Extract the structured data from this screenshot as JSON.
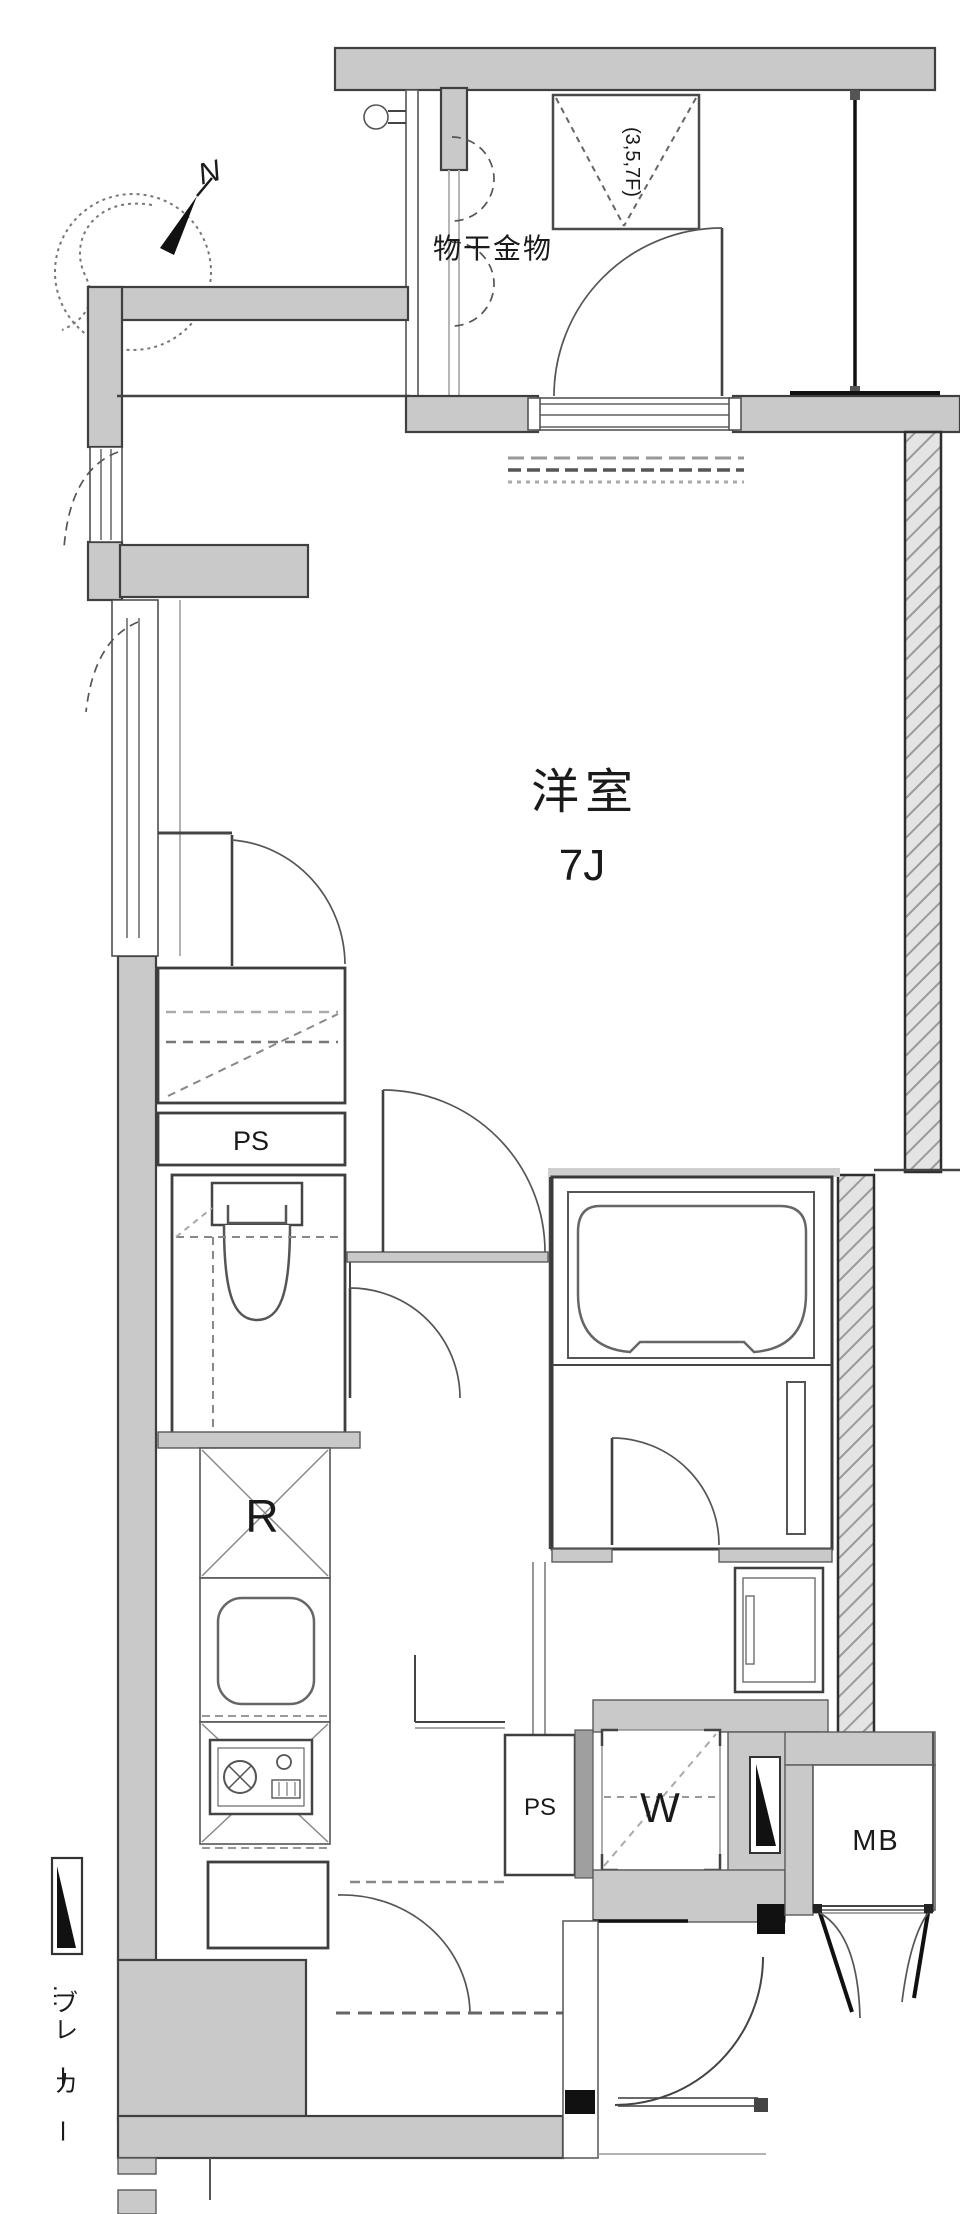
{
  "colors": {
    "wall_fill": "#c9c9c9",
    "wall_stroke": "#3f3f3f",
    "line": "#444444",
    "hatch_bg": "#e4e4e4",
    "hatch_line": "#9a9a9a",
    "black": "#111111",
    "background": "#ffffff"
  },
  "compass": {
    "north_label": "N"
  },
  "balcony": {
    "laundry_label": "物干金物",
    "floors_note": "(3,5,7F)"
  },
  "room": {
    "name": "洋室",
    "size_label": "7J"
  },
  "fixtures": {
    "ps_upper_label": "PS",
    "ps_lower_label": "PS",
    "refrigerator_label": "R",
    "washer_label": "W",
    "meter_box_label": "MB"
  },
  "legend": {
    "breaker_label": "…ブレーカー"
  }
}
